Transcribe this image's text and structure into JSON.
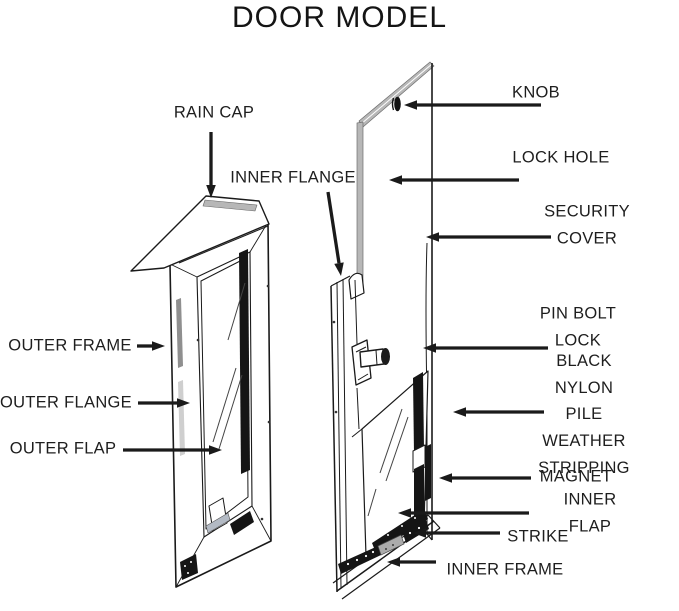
{
  "title": "DOOR MODEL",
  "colors": {
    "ink": "#1a1a1a",
    "gray": "#b7b7b7",
    "light_gray": "#d6d6d6",
    "steel": "#b3bac4",
    "label": "#1e1e1e",
    "background": "#ffffff"
  },
  "parts": [
    {
      "id": "rain-cap",
      "label": "RAIN CAP",
      "label_x": 214,
      "label_y": 113,
      "arrow": [
        211,
        132,
        211,
        198
      ]
    },
    {
      "id": "inner-flange",
      "label": "INNER FLANGE",
      "label_x": 293,
      "label_y": 178,
      "arrow": [
        328,
        192,
        341,
        276
      ]
    },
    {
      "id": "knob",
      "label": "KNOB",
      "label_x": 536,
      "label_y": 93,
      "arrow": [
        541,
        105,
        404,
        105
      ]
    },
    {
      "id": "lock-hole",
      "label": "LOCK HOLE",
      "label_x": 561,
      "label_y": 158,
      "arrow": [
        519,
        180,
        389,
        180
      ]
    },
    {
      "id": "security-cover",
      "label": "SECURITY COVER",
      "label_x": 587,
      "label_y": 225,
      "arrow": [
        551,
        237,
        426,
        237
      ]
    },
    {
      "id": "pin-bolt-lock",
      "label": "PIN BOLT LOCK",
      "label_x": 578,
      "label_y": 327,
      "arrow": [
        548,
        348,
        423,
        348
      ]
    },
    {
      "id": "outer-frame",
      "label": "OUTER FRAME",
      "label_x": 70,
      "label_y": 346,
      "arrow": [
        137,
        346,
        165,
        346
      ]
    },
    {
      "id": "outer-flange",
      "label": "OUTER FLANGE",
      "label_x": 66,
      "label_y": 403,
      "arrow": [
        138,
        403,
        190,
        403
      ]
    },
    {
      "id": "outer-flap",
      "label": "OUTER FLAP",
      "label_x": 63,
      "label_y": 449,
      "arrow": [
        123,
        450,
        222,
        450
      ]
    },
    {
      "id": "weather-stripping",
      "label": "BLACK NYLON PILE\nWEATHER STRIPPING",
      "label_x": 584,
      "label_y": 415,
      "arrow": [
        544,
        412,
        453,
        412
      ]
    },
    {
      "id": "magnet",
      "label": "MAGNET",
      "label_x": 576,
      "label_y": 477,
      "arrow": [
        531,
        478,
        439,
        478
      ]
    },
    {
      "id": "inner-flap",
      "label": "INNER FLAP",
      "label_x": 590,
      "label_y": 513,
      "arrow": [
        529,
        513,
        398,
        513
      ]
    },
    {
      "id": "strike",
      "label": "STRIKE",
      "label_x": 538,
      "label_y": 537,
      "arrow": [
        500,
        533,
        413,
        533
      ]
    },
    {
      "id": "inner-frame",
      "label": "INNER FRAME",
      "label_x": 505,
      "label_y": 570,
      "arrow": [
        436,
        562,
        387,
        562
      ]
    }
  ]
}
